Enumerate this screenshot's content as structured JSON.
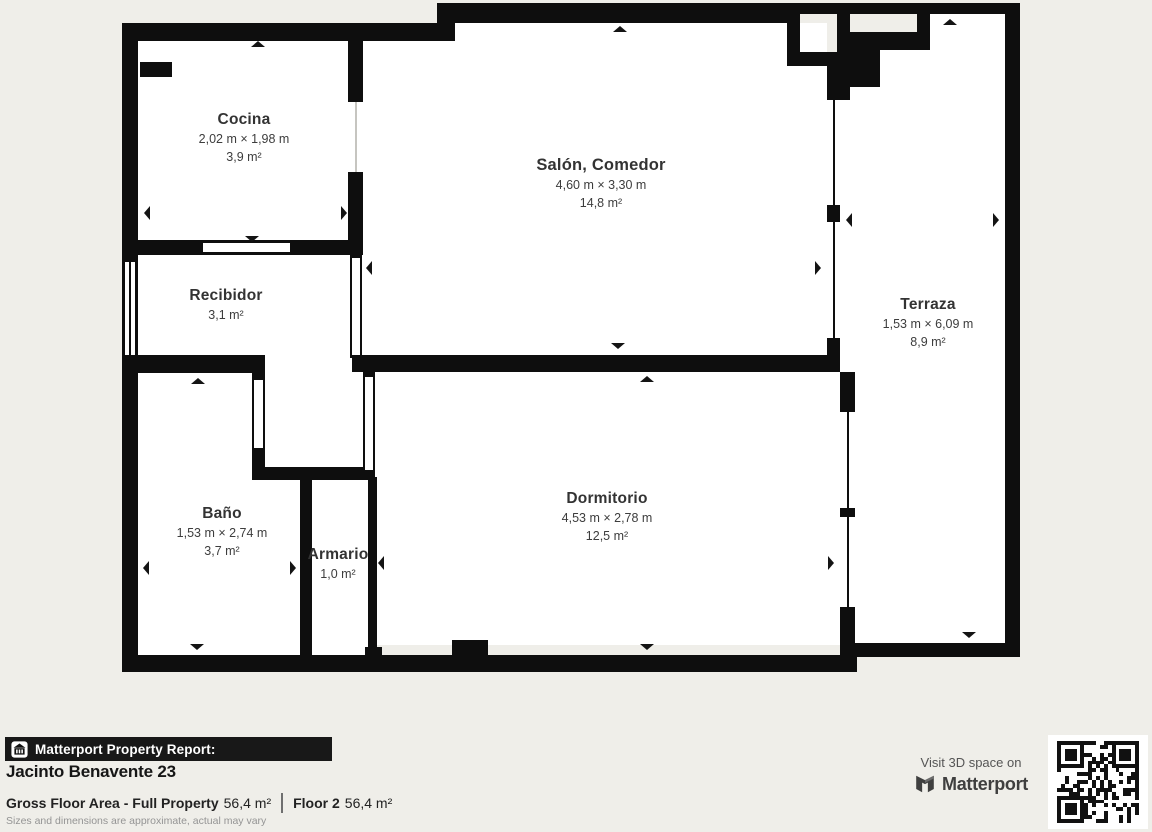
{
  "plan": {
    "rooms": [
      {
        "id": "cocina",
        "name": "Cocina",
        "dims": "2,02 m × 1,98 m",
        "area": "3,9 m²"
      },
      {
        "id": "salon",
        "name": "Salón, Comedor",
        "dims": "4,60 m × 3,30 m",
        "area": "14,8 m²"
      },
      {
        "id": "terraza",
        "name": "Terraza",
        "dims": "1,53 m × 6,09 m",
        "area": "8,9 m²"
      },
      {
        "id": "recibidor",
        "name": "Recibidor",
        "dims": null,
        "area": "3,1 m²"
      },
      {
        "id": "bano",
        "name": "Baño",
        "dims": "1,53 m × 2,74 m",
        "area": "3,7 m²"
      },
      {
        "id": "armario",
        "name": "Armario",
        "dims": null,
        "area": "1,0 m²"
      },
      {
        "id": "dormitorio",
        "name": "Dormitorio",
        "dims": "4,53 m × 2,78 m",
        "area": "12,5 m²"
      }
    ]
  },
  "report": {
    "bar_label": "Matterport Property Report:",
    "title": "Jacinto Benavente 23",
    "gross_area_label": "Gross Floor Area - Full Property",
    "gross_area_value": "56,4 m²",
    "floor_label": "Floor 2",
    "floor_value": "56,4 m²",
    "disclaimer": "Sizes and dimensions are approximate, actual may vary"
  },
  "cta": {
    "visit_text": "Visit 3D space on",
    "brand": "Matterport"
  },
  "colors": {
    "background": "#efeee9",
    "wall": "#0e0e0e",
    "room_fill": "#ffffff",
    "text": "#3d3d3d",
    "report_bar": "#181818",
    "brand_text": "#3f3f3f",
    "muted": "#949494"
  }
}
